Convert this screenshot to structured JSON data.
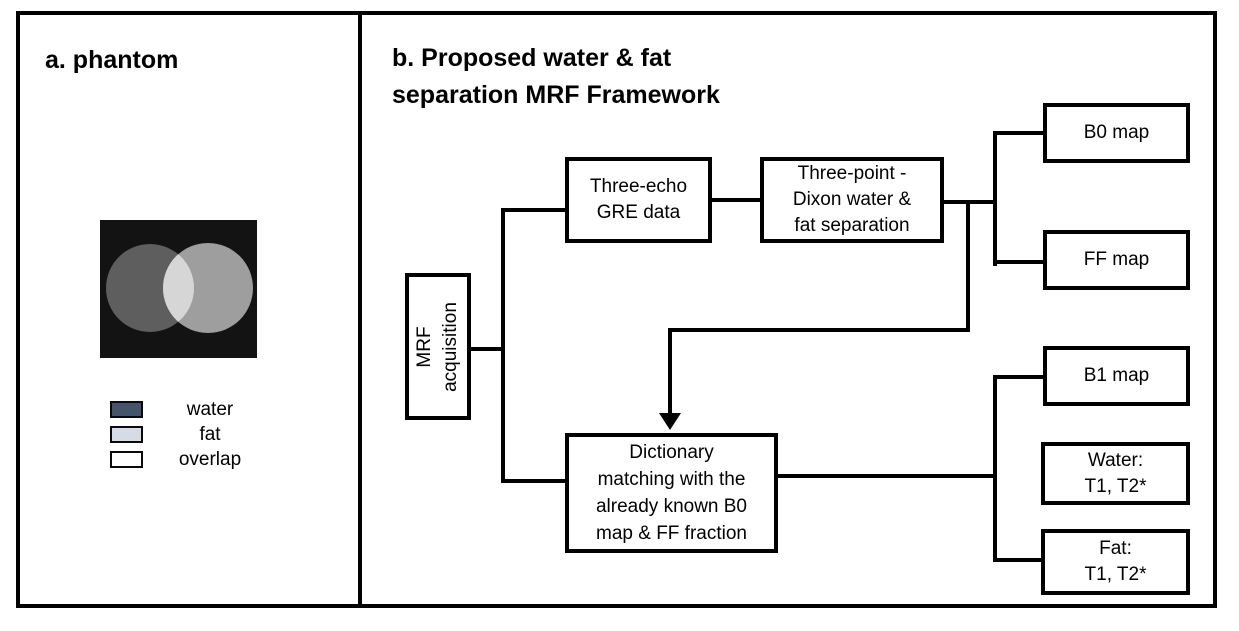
{
  "figure": {
    "panel_a": {
      "title": "a. phantom",
      "phantom": {
        "background_color": "#131313",
        "water_circle_color": "#5e5e5e",
        "fat_circle_color": "#9e9e9e",
        "overlap_color": "#d6d6d6"
      },
      "legend": {
        "items": [
          {
            "label": "water",
            "color": "#44546a"
          },
          {
            "label": "fat",
            "color": "#d6dce5"
          },
          {
            "label": "overlap",
            "color": "#ffffff"
          }
        ]
      }
    },
    "panel_b": {
      "title": [
        "b. Proposed water & fat",
        "separation MRF Framework"
      ],
      "boxes": {
        "mrf_acquisition": {
          "lines": [
            "MRF",
            "acquisition"
          ]
        },
        "three_echo": {
          "lines": [
            "Three-echo",
            "GRE data"
          ]
        },
        "dixon": {
          "lines": [
            "Three-point -",
            "Dixon water &",
            "fat separation"
          ]
        },
        "b0_map": {
          "lines": [
            "B0 map"
          ]
        },
        "ff_map": {
          "lines": [
            "FF map"
          ]
        },
        "dictionary": {
          "lines": [
            "Dictionary",
            "matching with the",
            "already known B0",
            "map & FF fraction"
          ]
        },
        "b1_map": {
          "lines": [
            "B1 map"
          ]
        },
        "water_maps": {
          "lines": [
            "Water:",
            "T1, T2*"
          ]
        },
        "fat_maps": {
          "lines": [
            "Fat:",
            "T1, T2*"
          ]
        }
      }
    }
  }
}
